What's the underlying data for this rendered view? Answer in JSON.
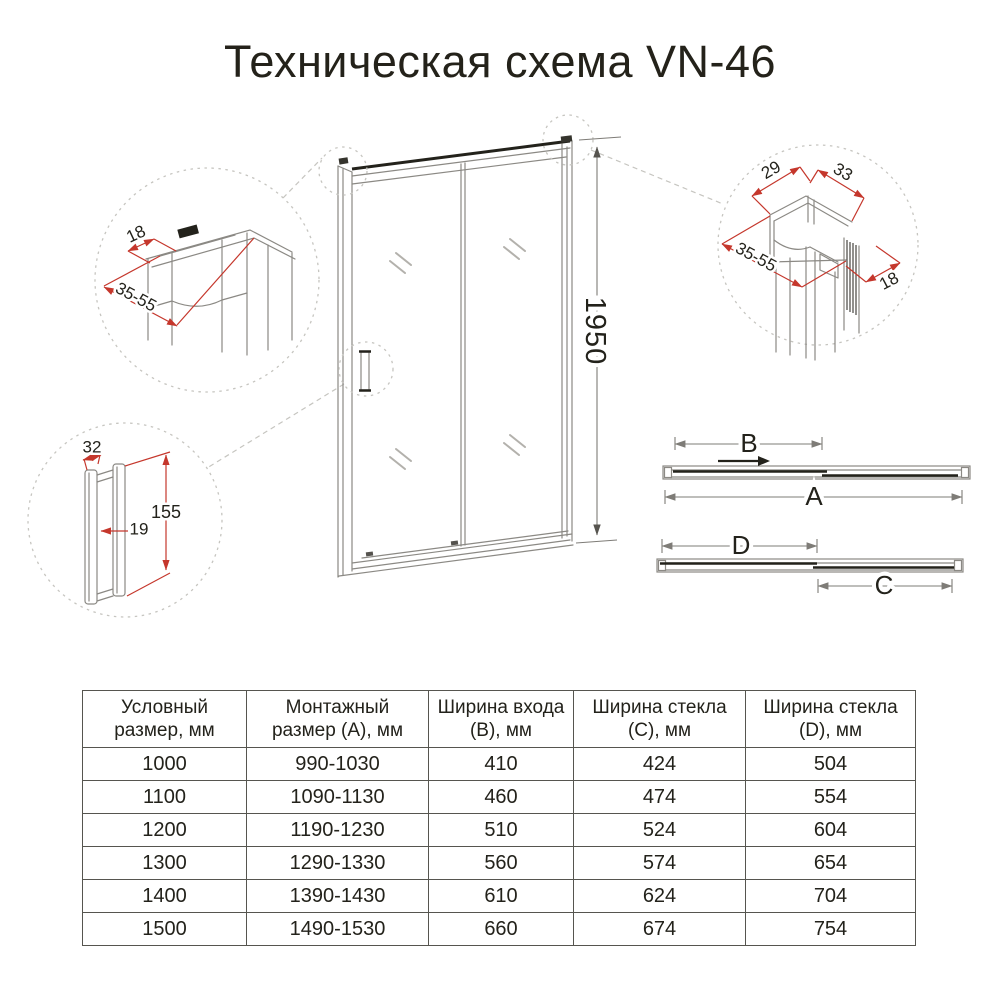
{
  "title": "Техническая схема VN-46",
  "diagram": {
    "door_height": "1950",
    "plan_top": {
      "entry_width_label": "B",
      "mount_width_label": "A"
    },
    "plan_bottom": {
      "glass_d_label": "D",
      "glass_c_label": "C"
    },
    "detail_top_left": {
      "profile_depth": "18",
      "adjust_range": "35-55"
    },
    "detail_top_right": {
      "dim_29": "29",
      "dim_33": "33",
      "adjust_range": "35-55",
      "profile_depth": "18"
    },
    "detail_handle": {
      "width": "32",
      "length": "155",
      "gap": "19"
    },
    "colors": {
      "dimension_red": "#c5372c",
      "drawing_gray": "#8b8984",
      "dark": "#23221b"
    }
  },
  "table": {
    "headers": [
      "Условный размер, мм",
      "Монтажный размер (А), мм",
      "Ширина входа (В), мм",
      "Ширина стекла (С), мм",
      "Ширина стекла (D), мм"
    ],
    "rows": [
      [
        "1000",
        "990-1030",
        "410",
        "424",
        "504"
      ],
      [
        "1100",
        "1090-1130",
        "460",
        "474",
        "554"
      ],
      [
        "1200",
        "1190-1230",
        "510",
        "524",
        "604"
      ],
      [
        "1300",
        "1290-1330",
        "560",
        "574",
        "654"
      ],
      [
        "1400",
        "1390-1430",
        "610",
        "624",
        "704"
      ],
      [
        "1500",
        "1490-1530",
        "660",
        "674",
        "754"
      ]
    ]
  }
}
